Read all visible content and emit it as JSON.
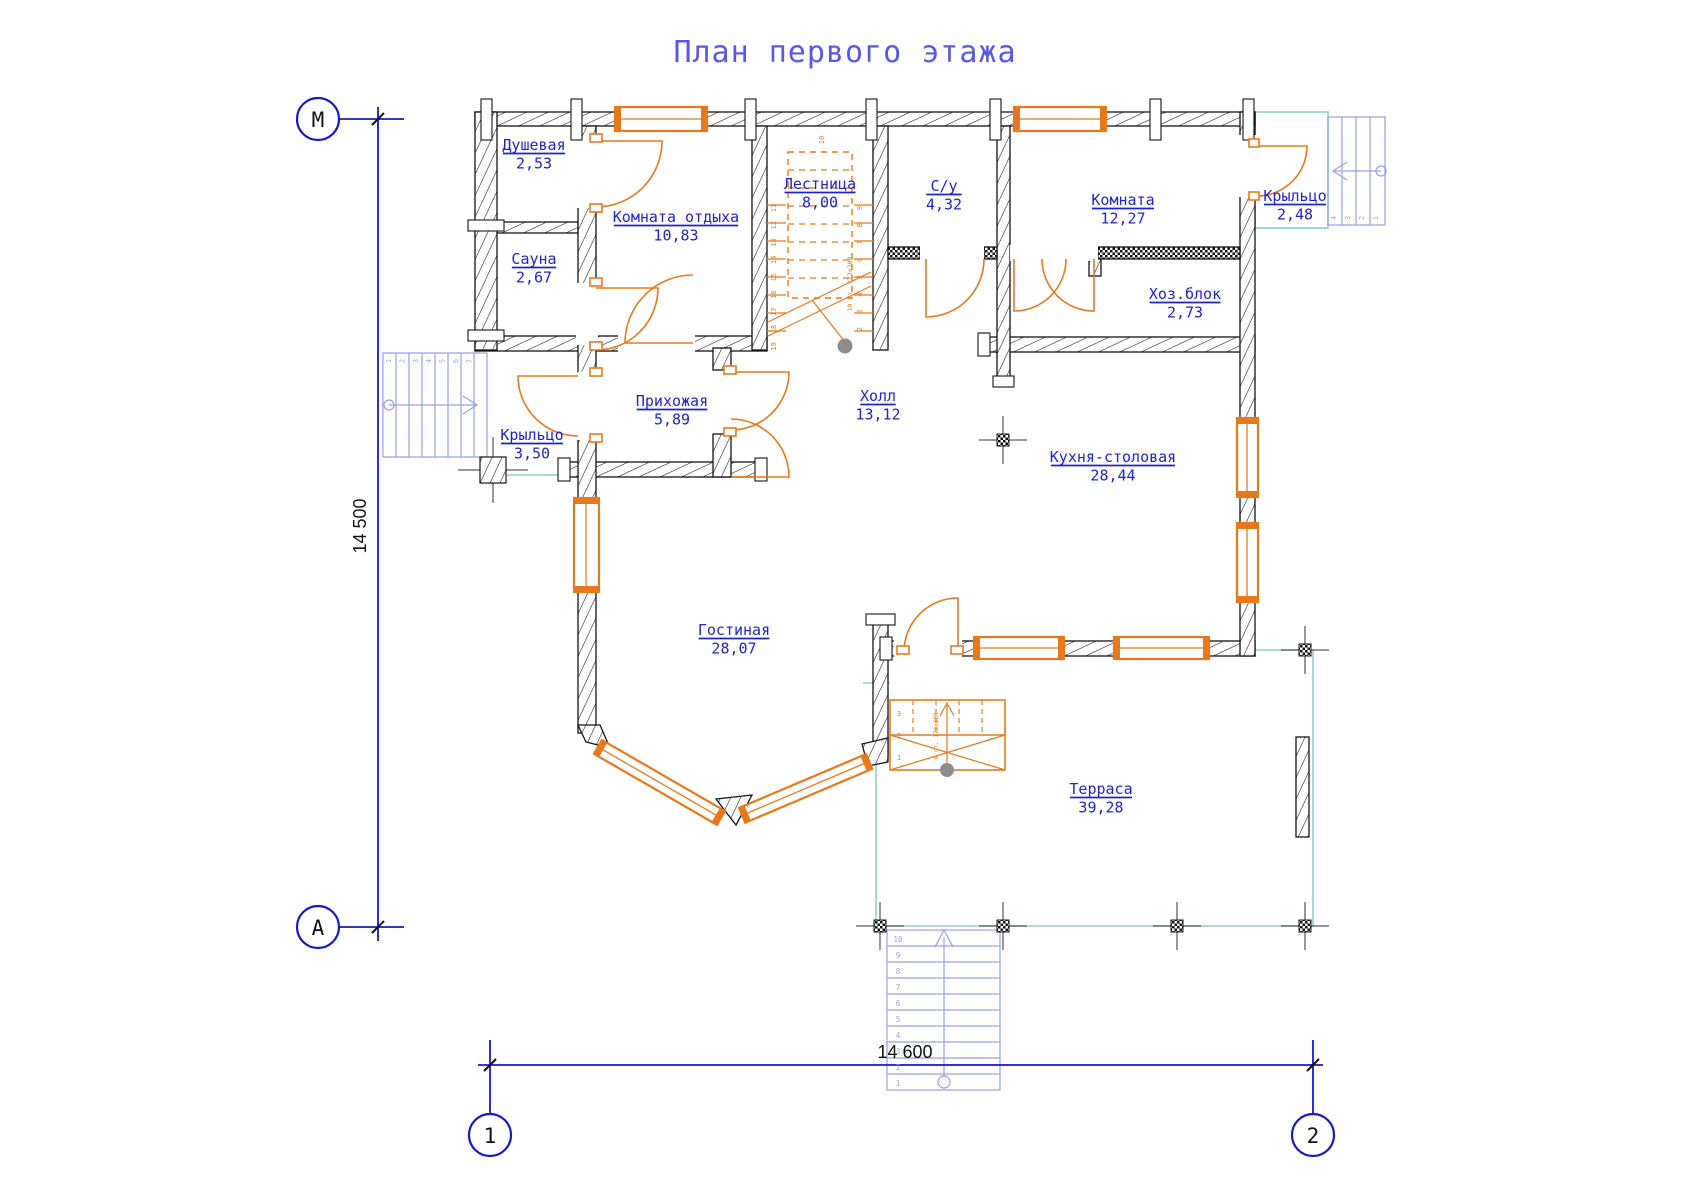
{
  "title": "План первого этажа",
  "axes": {
    "left_top": "М",
    "left_bottom": "А",
    "bottom_left": "1",
    "bottom_right": "2"
  },
  "dimensions": {
    "vertical": "14 500",
    "horizontal": "14 600"
  },
  "rooms": [
    {
      "id": "dushevaya",
      "name": "Душевая",
      "area": "2,53"
    },
    {
      "id": "sauna",
      "name": "Сауна",
      "area": "2,67"
    },
    {
      "id": "komnata_otdyha",
      "name": "Комната отдыха",
      "area": "10,83"
    },
    {
      "id": "lestnitsa",
      "name": "Лестница",
      "area": "8,00"
    },
    {
      "id": "su",
      "name": "С/у",
      "area": "4,32"
    },
    {
      "id": "komnata",
      "name": "Комната",
      "area": "12,27"
    },
    {
      "id": "kryltso_right",
      "name": "Крыльцо",
      "area": "2,48"
    },
    {
      "id": "hozblok",
      "name": "Хоз.блок",
      "area": "2,73"
    },
    {
      "id": "prihozhaya",
      "name": "Прихожая",
      "area": "5,89"
    },
    {
      "id": "kryltso_left",
      "name": "Крыльцо",
      "area": "3,50"
    },
    {
      "id": "holl",
      "name": "Холл",
      "area": "13,12"
    },
    {
      "id": "kuhnya",
      "name": "Кухня-столовая",
      "area": "28,44"
    },
    {
      "id": "gostinaya",
      "name": "Гостиная",
      "area": "28,07"
    },
    {
      "id": "terrasa",
      "name": "Терраса",
      "area": "39,28"
    }
  ],
  "stairs": {
    "central": {
      "top_number": "10",
      "left_numbers": [
        "11",
        "12",
        "13",
        "14",
        "15",
        "16",
        "17",
        "18",
        "19"
      ],
      "right_numbers": [
        "9",
        "8",
        "7",
        "6",
        "5",
        "4",
        "3",
        "2"
      ],
      "note": "19 ст. 173х300"
    },
    "left_porch": {
      "numbers": [
        "1",
        "2",
        "3",
        "4",
        "5",
        "6",
        "7"
      ]
    },
    "right_porch": {
      "numbers": [
        "4",
        "3",
        "2",
        "1"
      ]
    },
    "terrace_inner": {
      "numbers": [
        "3",
        "2",
        "1"
      ],
      "note": "9 ст. 173х300"
    },
    "terrace_main": {
      "numbers": [
        "10",
        "9",
        "8",
        "7",
        "6",
        "5",
        "4",
        "3",
        "2",
        "1"
      ]
    }
  },
  "colors": {
    "orange": "#E8791B",
    "label_blue": "#1F24C7",
    "dim_blue": "#1718C9",
    "title_blue": "#5858E8",
    "lavender": "#9B9FE0",
    "teal": "#8FD0C4",
    "wall": "#141414",
    "gray": "#8C8C8C",
    "black_text": "#111111"
  }
}
